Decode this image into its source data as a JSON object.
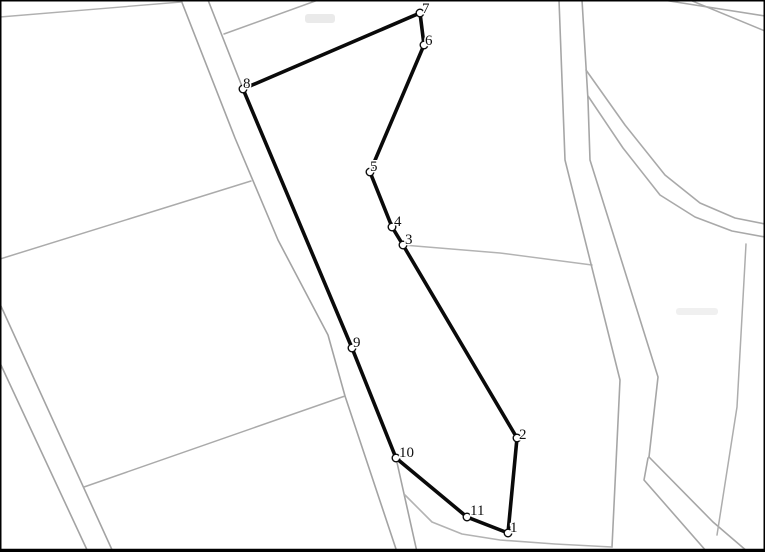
{
  "canvas": {
    "width": 765,
    "height": 552,
    "background_color": "#ffffff",
    "frame_border_color": "#000000",
    "frame_border_width": 1.5,
    "bottom_border_width": 3.2
  },
  "colors": {
    "parcel_outline": "#0a0a0a",
    "parcel_outline_width": 3.6,
    "vertex_fill": "#ffffff",
    "vertex_stroke": "#0a0a0a",
    "vertex_radius": 3.8,
    "label_color": "#111111",
    "boundary_default": "#a6a6a6"
  },
  "parcel": {
    "closed": true,
    "vertices": [
      {
        "label": "1",
        "x": 508,
        "y": 533,
        "label_x": 510,
        "label_y": 532
      },
      {
        "label": "2",
        "x": 517,
        "y": 438,
        "label_x": 519,
        "label_y": 439
      },
      {
        "label": "3",
        "x": 403,
        "y": 245,
        "label_x": 405,
        "label_y": 244
      },
      {
        "label": "4",
        "x": 392,
        "y": 227,
        "label_x": 394,
        "label_y": 226
      },
      {
        "label": "5",
        "x": 370,
        "y": 172,
        "label_x": 370,
        "label_y": 171
      },
      {
        "label": "6",
        "x": 424,
        "y": 45,
        "label_x": 425,
        "label_y": 45
      },
      {
        "label": "7",
        "x": 420,
        "y": 13,
        "label_x": 422,
        "label_y": 13
      },
      {
        "label": "8",
        "x": 243,
        "y": 89,
        "label_x": 243,
        "label_y": 88
      },
      {
        "label": "9",
        "x": 352,
        "y": 348,
        "label_x": 353,
        "label_y": 347
      },
      {
        "label": "10",
        "x": 396,
        "y": 458,
        "label_x": 399,
        "label_y": 457
      },
      {
        "label": "11",
        "x": 467,
        "y": 517,
        "label_x": 470,
        "label_y": 515
      }
    ]
  },
  "boundaries": [
    {
      "name": "road-west-left-line",
      "color": "#a3a3a3",
      "width": 1.6,
      "points": [
        [
          181,
          0
        ],
        [
          235,
          138
        ],
        [
          278,
          240
        ],
        [
          328,
          335
        ],
        [
          345,
          396
        ],
        [
          368,
          465
        ],
        [
          397,
          552
        ]
      ]
    },
    {
      "name": "road-west-right-line",
      "color": "#a3a3a3",
      "width": 1.6,
      "points": [
        [
          208,
          0
        ],
        [
          243,
          89
        ],
        [
          307,
          240
        ],
        [
          352,
          348
        ],
        [
          396,
          458
        ],
        [
          417,
          552
        ]
      ]
    },
    {
      "name": "road-southwest-upper",
      "color": "#a3a3a3",
      "width": 1.6,
      "points": [
        [
          0,
          304
        ],
        [
          113,
          552
        ]
      ]
    },
    {
      "name": "road-southwest-lower",
      "color": "#a3a3a3",
      "width": 1.6,
      "points": [
        [
          0,
          363
        ],
        [
          88,
          552
        ]
      ]
    },
    {
      "name": "branch-sw-to-west-road",
      "color": "#aaaaaa",
      "width": 1.5,
      "points": [
        [
          84,
          487
        ],
        [
          345,
          396
        ]
      ]
    },
    {
      "name": "west-diagonal-boundary",
      "color": "#ababab",
      "width": 1.5,
      "points": [
        [
          0,
          259
        ],
        [
          251,
          181
        ]
      ]
    },
    {
      "name": "topleft-boundary",
      "color": "#b0b0b0",
      "width": 1.4,
      "points": [
        [
          0,
          17
        ],
        [
          181,
          2
        ]
      ]
    },
    {
      "name": "top-branch-boundary",
      "color": "#aaaaaa",
      "width": 1.5,
      "points": [
        [
          224,
          34
        ],
        [
          318,
          0
        ]
      ]
    },
    {
      "name": "vertex3-east-boundary",
      "color": "#b3b3b3",
      "width": 1.5,
      "points": [
        [
          403,
          245
        ],
        [
          500,
          253
        ],
        [
          592,
          265
        ]
      ]
    },
    {
      "name": "road-east-left-line",
      "color": "#a6a6a6",
      "width": 1.6,
      "points": [
        [
          559,
          0
        ],
        [
          565,
          160
        ],
        [
          620,
          380
        ],
        [
          612,
          547
        ]
      ]
    },
    {
      "name": "road-east-right-line",
      "color": "#a6a6a6",
      "width": 1.6,
      "points": [
        [
          582,
          0
        ],
        [
          588,
          100
        ],
        [
          590,
          160
        ],
        [
          658,
          377
        ],
        [
          649,
          457
        ]
      ]
    },
    {
      "name": "road-southeast-upper",
      "color": "#a6a6a6",
      "width": 1.6,
      "points": [
        [
          649,
          457
        ],
        [
          713,
          522
        ],
        [
          748,
          552
        ]
      ]
    },
    {
      "name": "road-southeast-lower",
      "color": "#a6a6a6",
      "width": 1.6,
      "points": [
        [
          648,
          458
        ],
        [
          644,
          480
        ],
        [
          707,
          552
        ]
      ]
    },
    {
      "name": "south-curved-boundary",
      "color": "#b3b3b3",
      "width": 1.6,
      "points": [
        [
          405,
          495
        ],
        [
          432,
          522
        ],
        [
          462,
          534
        ],
        [
          500,
          540
        ],
        [
          555,
          544
        ],
        [
          612,
          547
        ]
      ]
    },
    {
      "name": "ne-corner-band-outer",
      "color": "#a9a9a9",
      "width": 1.5,
      "points": [
        [
          663,
          0
        ],
        [
          765,
          16
        ]
      ]
    },
    {
      "name": "ne-corner-band-inner",
      "color": "#a9a9a9",
      "width": 1.5,
      "points": [
        [
          690,
          0
        ],
        [
          765,
          31
        ]
      ]
    },
    {
      "name": "curved-road-upper",
      "color": "#a9a9a9",
      "width": 1.6,
      "points": [
        [
          586,
          70
        ],
        [
          625,
          125
        ],
        [
          665,
          175
        ],
        [
          700,
          203
        ],
        [
          735,
          218
        ],
        [
          765,
          224
        ]
      ]
    },
    {
      "name": "curved-road-lower",
      "color": "#a9a9a9",
      "width": 1.6,
      "points": [
        [
          588,
          96
        ],
        [
          623,
          148
        ],
        [
          660,
          195
        ],
        [
          695,
          217
        ],
        [
          732,
          231
        ],
        [
          765,
          237
        ]
      ]
    },
    {
      "name": "east-parcel-line",
      "color": "#adadad",
      "width": 1.5,
      "points": [
        [
          746,
          244
        ],
        [
          737,
          407
        ],
        [
          717,
          535
        ]
      ]
    }
  ],
  "artifacts": [
    {
      "name": "faint-smudge-top",
      "x": 305,
      "y": 14,
      "w": 30,
      "h": 9,
      "color": "#d9d9d9"
    },
    {
      "name": "faint-smudge-right",
      "x": 676,
      "y": 308,
      "w": 42,
      "h": 7,
      "color": "#e3e3e3"
    }
  ]
}
